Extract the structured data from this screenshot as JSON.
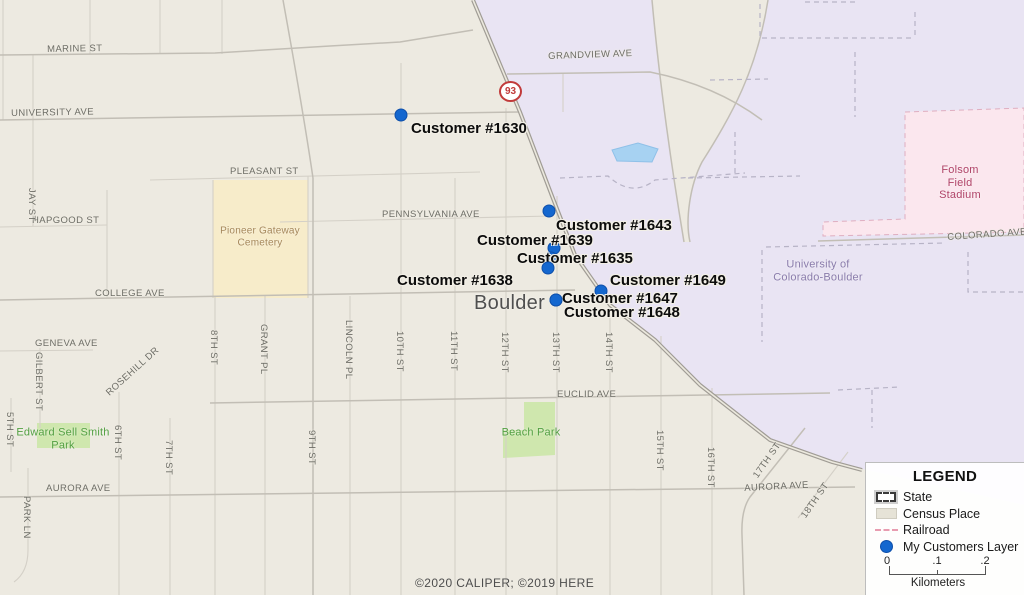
{
  "map": {
    "city_label": "Boulder",
    "highway_shield": "93",
    "copyright": "©2020 CALIPER; ©2019 HERE",
    "street_labels": [
      {
        "text": "MARINE ST",
        "x": 47,
        "y": 44,
        "rot": -1
      },
      {
        "text": "UNIVERSITY AVE",
        "x": 11,
        "y": 108,
        "rot": -1
      },
      {
        "text": "GRANDVIEW AVE",
        "x": 548,
        "y": 51,
        "rot": -2
      },
      {
        "text": "PLEASANT ST",
        "x": 230,
        "y": 166,
        "rot": 0
      },
      {
        "text": "HAPGOOD ST",
        "x": 32,
        "y": 215,
        "rot": 0
      },
      {
        "text": "PENNSYLVANIA AVE",
        "x": 382,
        "y": 209,
        "rot": 0
      },
      {
        "text": "COLLEGE AVE",
        "x": 95,
        "y": 288,
        "rot": 0
      },
      {
        "text": "GENEVA AVE",
        "x": 35,
        "y": 338,
        "rot": 0
      },
      {
        "text": "EUCLID AVE",
        "x": 557,
        "y": 389,
        "rot": 0
      },
      {
        "text": "AURORA AVE",
        "x": 46,
        "y": 483,
        "rot": 0
      },
      {
        "text": "AURORA AVE",
        "x": 744,
        "y": 483,
        "rot": -3
      },
      {
        "text": "COLORADO AVE",
        "x": 947,
        "y": 232,
        "rot": -4
      },
      {
        "text": "JAY ST",
        "x": 37,
        "y": 188,
        "rot": 90
      },
      {
        "text": "5TH ST",
        "x": 15,
        "y": 412,
        "rot": 90
      },
      {
        "text": "GILBERT ST",
        "x": 44,
        "y": 352,
        "rot": 90
      },
      {
        "text": "PARK LN",
        "x": 32,
        "y": 496,
        "rot": 90
      },
      {
        "text": "6TH ST",
        "x": 123,
        "y": 425,
        "rot": 90
      },
      {
        "text": "7TH ST",
        "x": 174,
        "y": 440,
        "rot": 90
      },
      {
        "text": "8TH ST",
        "x": 219,
        "y": 330,
        "rot": 90
      },
      {
        "text": "GRANT PL",
        "x": 269,
        "y": 324,
        "rot": 90
      },
      {
        "text": "9TH ST",
        "x": 317,
        "y": 430,
        "rot": 90
      },
      {
        "text": "LINCOLN PL",
        "x": 354,
        "y": 320,
        "rot": 90
      },
      {
        "text": "10TH ST",
        "x": 405,
        "y": 331,
        "rot": 90
      },
      {
        "text": "11TH ST",
        "x": 459,
        "y": 331,
        "rot": 90
      },
      {
        "text": "12TH ST",
        "x": 510,
        "y": 332,
        "rot": 90
      },
      {
        "text": "13TH ST",
        "x": 561,
        "y": 332,
        "rot": 90
      },
      {
        "text": "14TH ST",
        "x": 614,
        "y": 332,
        "rot": 90
      },
      {
        "text": "15TH ST",
        "x": 665,
        "y": 430,
        "rot": 90
      },
      {
        "text": "16TH ST",
        "x": 716,
        "y": 447,
        "rot": 90
      },
      {
        "text": "17TH ST",
        "x": 751,
        "y": 474,
        "rot": -55
      },
      {
        "text": "18TH ST",
        "x": 799,
        "y": 514,
        "rot": -55
      },
      {
        "text": "ROSEHILL DR",
        "x": 104,
        "y": 390,
        "rot": -42
      }
    ],
    "area_labels": [
      {
        "name": "pioneer-gateway-cemetery-label",
        "lines": [
          "Pioneer Gateway",
          "Cemetery"
        ],
        "x": 260,
        "y": 237,
        "color": "#a5875a",
        "size": 10
      },
      {
        "name": "edward-sell-smith-park-label",
        "lines": [
          "Edward Sell Smith",
          "Park"
        ],
        "x": 63,
        "y": 439,
        "color": "#53a042",
        "size": 11
      },
      {
        "name": "beach-park-label",
        "lines": [
          "Beach Park"
        ],
        "x": 531,
        "y": 433,
        "color": "#53a042",
        "size": 11
      },
      {
        "name": "folsom-field-stadium-label",
        "lines": [
          "Folsom Field",
          "Stadium"
        ],
        "x": 960,
        "y": 183,
        "color": "#b04468",
        "size": 11
      },
      {
        "name": "university-label",
        "lines": [
          "University of",
          "Colorado-Boulder"
        ],
        "x": 818,
        "y": 271,
        "color": "#8a7cab",
        "size": 11
      }
    ],
    "customers": [
      {
        "id": "1630",
        "label": "Customer #1630",
        "dot_x": 401,
        "dot_y": 115,
        "label_x": 411,
        "label_y": 121
      },
      {
        "id": "1643",
        "label": "Customer #1643",
        "dot_x": 549,
        "dot_y": 211,
        "label_x": 556,
        "label_y": 218
      },
      {
        "id": "1639",
        "label": "Customer #1639",
        "dot_x": 554,
        "dot_y": 248,
        "label_x": 477,
        "label_y": 233
      },
      {
        "id": "1635",
        "label": "Customer #1635",
        "dot_x": 551,
        "dot_y": 258,
        "label_x": 517,
        "label_y": 251
      },
      {
        "id": "1638",
        "label": "Customer #1638",
        "dot_x": 548,
        "dot_y": 268,
        "label_x": 397,
        "label_y": 273
      },
      {
        "id": "1649",
        "label": "Customer #1649",
        "dot_x": 601,
        "dot_y": 291,
        "label_x": 610,
        "label_y": 273
      },
      {
        "id": "1647",
        "label": "Customer #1647",
        "dot_x": 556,
        "dot_y": 300,
        "label_x": 562,
        "label_y": 291
      },
      {
        "id": "1648",
        "label": "Customer #1648",
        "dot_x": 556,
        "dot_y": 300,
        "label_x": 564,
        "label_y": 305
      }
    ]
  },
  "legend": {
    "title": "LEGEND",
    "items": [
      {
        "symbol": "state",
        "label": "State"
      },
      {
        "symbol": "census",
        "label": "Census Place"
      },
      {
        "symbol": "railroad",
        "label": "Railroad"
      },
      {
        "symbol": "customers",
        "label": "My Customers Layer"
      }
    ],
    "scale": {
      "ticks": [
        "0",
        ".1",
        ".2"
      ],
      "tick_x": [
        21,
        71,
        119
      ],
      "unit": "Kilometers"
    }
  },
  "colors": {
    "customer_dot": "#1467cf",
    "railroad": "#e89cb0",
    "map_bg": "#edeae1",
    "campus": "#e9e4f3",
    "stadium": "#fbe7ee",
    "cemetery": "#f7ecca",
    "park": "#cfe7ae",
    "pond": "#a7d2f2"
  }
}
